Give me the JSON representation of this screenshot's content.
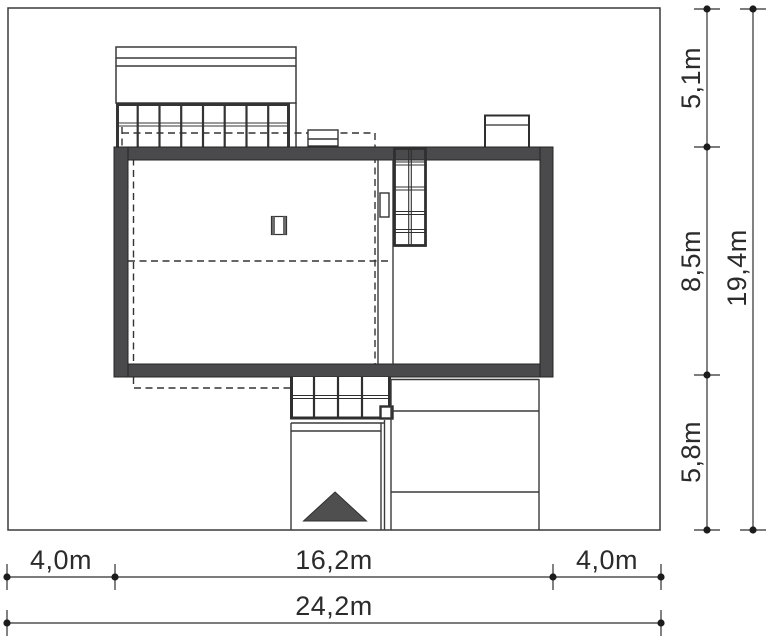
{
  "drawing": {
    "type": "architectural-site-plan",
    "units": "m"
  },
  "dims": {
    "bottom": {
      "segments": [
        {
          "label": "4,0m"
        },
        {
          "label": "16,2m"
        },
        {
          "label": "4,0m"
        }
      ],
      "total": {
        "label": "24,2m"
      }
    },
    "right": {
      "segments": [
        {
          "label": "5,1m"
        },
        {
          "label": "8,5m"
        },
        {
          "label": "5,8m"
        }
      ],
      "total": {
        "label": "19,4m"
      }
    }
  },
  "colors": {
    "wall_fill": "#4a4a4c",
    "line": "#2f2f2f",
    "entrance_arrow": "#4f4f50",
    "background": "#ffffff"
  }
}
